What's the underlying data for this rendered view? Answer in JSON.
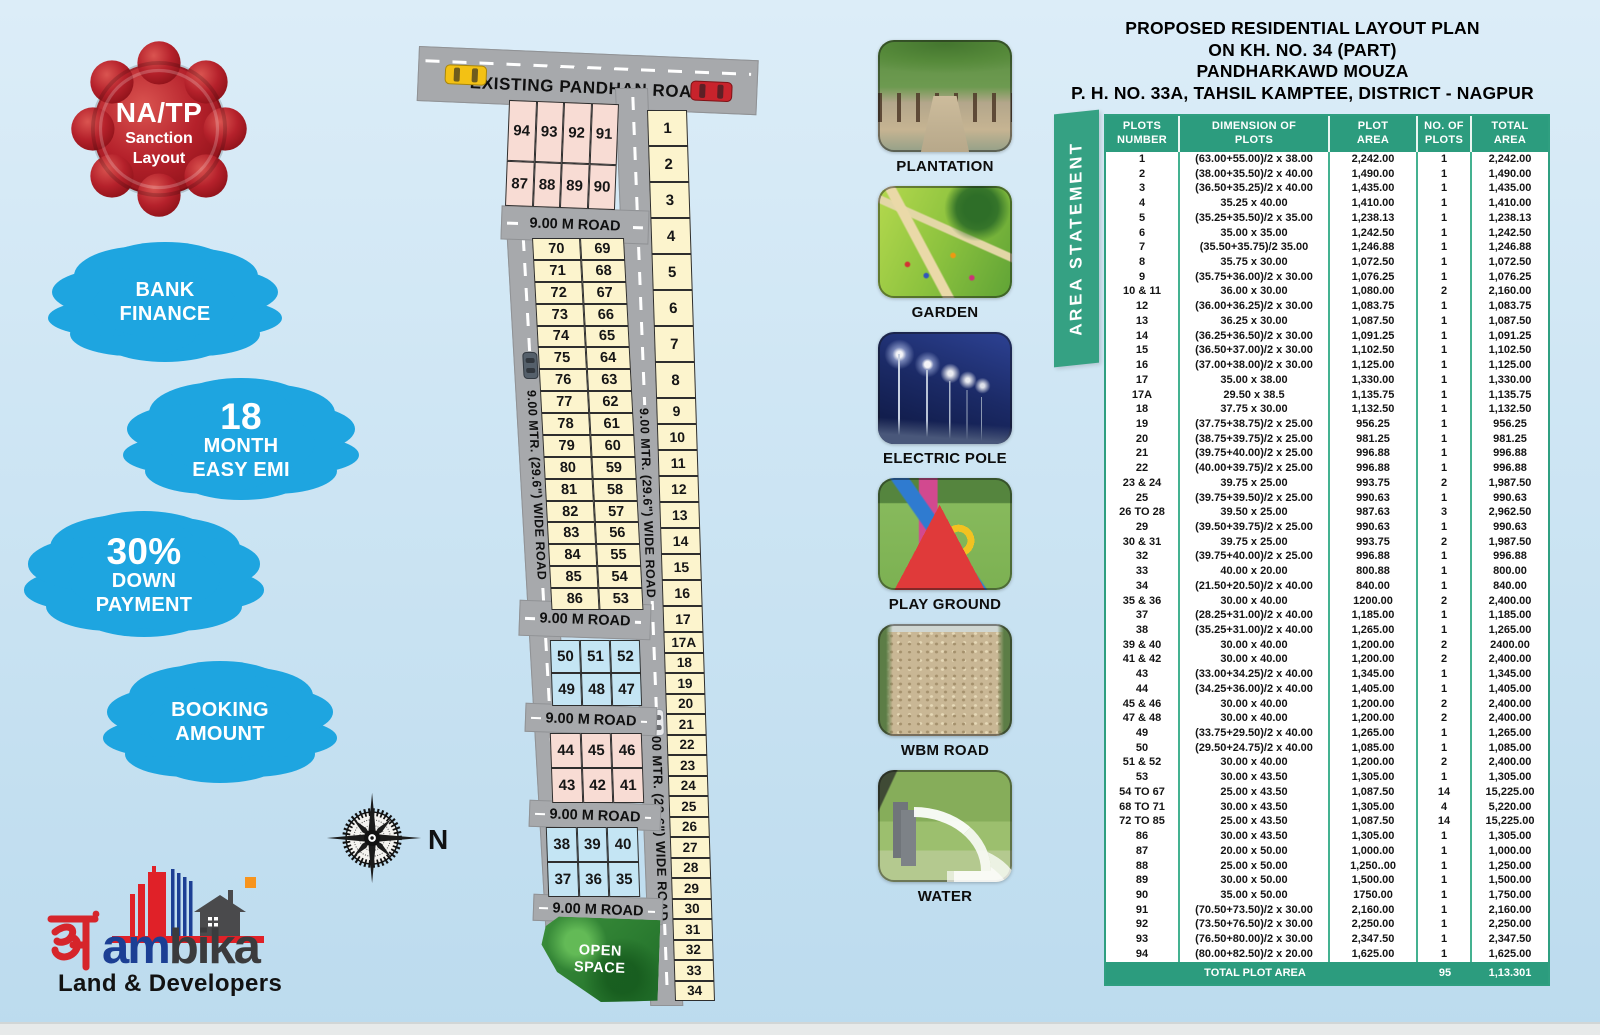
{
  "left_panel": {
    "seal": {
      "l1": "NA/TP",
      "l2": "Sanction",
      "l3": "Layout"
    },
    "cloud_bank": {
      "l1": "BANK",
      "l2": "FINANCE"
    },
    "cloud_emi": {
      "big": "18",
      "l1": "MONTH",
      "l2": "EASY EMI"
    },
    "cloud_down": {
      "big": "30%",
      "l1": "DOWN",
      "l2": "PAYMENT"
    },
    "cloud_booking": {
      "l1": "BOOKING",
      "l2": "AMOUNT"
    },
    "compass_north": "N",
    "logo": {
      "devanagari": "अं",
      "name_blue": "am",
      "name_dark": "bika",
      "tagline": "Land & Developers"
    }
  },
  "map": {
    "top_road": "EXISTING PANDHAN ROAD",
    "road_label": "9.00 M ROAD",
    "wide_road_label": "9.00 MTR. (29.6\") WIDE ROAD",
    "open_space_l1": "OPEN",
    "open_space_l2": "SPACE",
    "pink_top": [
      [
        "94",
        "93",
        "92",
        "91"
      ],
      [
        "87",
        "88",
        "89",
        "90"
      ]
    ],
    "mid_rows": [
      [
        "70",
        "69"
      ],
      [
        "71",
        "68"
      ],
      [
        "72",
        "67"
      ],
      [
        "73",
        "66"
      ],
      [
        "74",
        "65"
      ],
      [
        "75",
        "64"
      ],
      [
        "76",
        "63"
      ],
      [
        "77",
        "62"
      ],
      [
        "78",
        "61"
      ],
      [
        "79",
        "60"
      ],
      [
        "80",
        "59"
      ],
      [
        "81",
        "58"
      ],
      [
        "82",
        "57"
      ],
      [
        "83",
        "56"
      ],
      [
        "84",
        "55"
      ],
      [
        "85",
        "54"
      ],
      [
        "86",
        "53"
      ]
    ],
    "right_col": [
      "1",
      "2",
      "3",
      "4",
      "5",
      "6",
      "7",
      "8",
      "9",
      "10",
      "11",
      "12",
      "13",
      "14",
      "15",
      "16",
      "17",
      "17A",
      "18",
      "19",
      "20",
      "21",
      "22",
      "23",
      "24",
      "25",
      "26",
      "27",
      "28",
      "29",
      "30",
      "31",
      "32",
      "33",
      "34"
    ],
    "blue_block_a": [
      [
        "50",
        "51",
        "52"
      ],
      [
        "49",
        "48",
        "47"
      ]
    ],
    "pink_block_b": [
      [
        "44",
        "45",
        "46"
      ],
      [
        "43",
        "42",
        "41"
      ]
    ],
    "blue_block_c": [
      [
        "38",
        "39",
        "40"
      ],
      [
        "37",
        "36",
        "35"
      ]
    ]
  },
  "gallery": [
    {
      "label": "PLANTATION",
      "art": "plantation"
    },
    {
      "label": "GARDEN",
      "art": "garden"
    },
    {
      "label": "ELECTRIC POLE",
      "art": "electric"
    },
    {
      "label": "PLAY GROUND",
      "art": "playground"
    },
    {
      "label": "WBM ROAD",
      "art": "wbm"
    },
    {
      "label": "WATER",
      "art": "water"
    }
  ],
  "statement": {
    "title_lines": [
      "PROPOSED RESIDENTIAL LAYOUT PLAN",
      "ON KH. NO. 34 (PART)",
      "PANDHARKAWD MOUZA",
      "P. H. NO. 33A, TAHSIL KAMPTEE, DISTRICT - NAGPUR"
    ],
    "banner": "AREA STATEMENT",
    "headers": [
      [
        "PLOTS",
        "NUMBER"
      ],
      [
        "DIMENSION OF",
        "PLOTS"
      ],
      [
        "PLOT",
        "AREA"
      ],
      [
        "NO. OF",
        "PLOTS"
      ],
      [
        "TOTAL",
        "AREA"
      ]
    ],
    "rows": [
      [
        "1",
        "(63.00+55.00)/2 x 38.00",
        "2,242.00",
        "1",
        "2,242.00"
      ],
      [
        "2",
        "(38.00+35.50)/2 x 40.00",
        "1,490.00",
        "1",
        "1,490.00"
      ],
      [
        "3",
        "(36.50+35.25)/2 x 40.00",
        "1,435.00",
        "1",
        "1,435.00"
      ],
      [
        "4",
        "35.25 x 40.00",
        "1,410.00",
        "1",
        "1,410.00"
      ],
      [
        "5",
        "(35.25+35.50)/2 x 35.00",
        "1,238.13",
        "1",
        "1,238.13"
      ],
      [
        "6",
        "35.00 x 35.00",
        "1,242.50",
        "1",
        "1,242.50"
      ],
      [
        "7",
        "(35.50+35.75)/2 35.00",
        "1,246.88",
        "1",
        "1,246.88"
      ],
      [
        "8",
        "35.75 x 30.00",
        "1,072.50",
        "1",
        "1,072.50"
      ],
      [
        "9",
        "(35.75+36.00)/2 x 30.00",
        "1,076.25",
        "1",
        "1,076.25"
      ],
      [
        "10 & 11",
        "36.00 x 30.00",
        "1,080.00",
        "2",
        "2,160.00"
      ],
      [
        "12",
        "(36.00+36.25)/2 x 30.00",
        "1,083.75",
        "1",
        "1,083.75"
      ],
      [
        "13",
        "36.25 x 30.00",
        "1,087.50",
        "1",
        "1,087.50"
      ],
      [
        "14",
        "(36.25+36.50)/2 x 30.00",
        "1,091.25",
        "1",
        "1,091.25"
      ],
      [
        "15",
        "(36.50+37.00)/2 x 30.00",
        "1,102.50",
        "1",
        "1,102.50"
      ],
      [
        "16",
        "(37.00+38.00)/2 x 30.00",
        "1,125.00",
        "1",
        "1,125.00"
      ],
      [
        "17",
        "35.00 x 38.00",
        "1,330.00",
        "1",
        "1,330.00"
      ],
      [
        "17A",
        "29.50 x 38.5",
        "1,135.75",
        "1",
        "1,135.75"
      ],
      [
        "18",
        "37.75 x 30.00",
        "1,132.50",
        "1",
        "1,132.50"
      ],
      [
        "19",
        "(37.75+38.75)/2 x 25.00",
        "956.25",
        "1",
        "956.25"
      ],
      [
        "20",
        "(38.75+39.75)/2 x 25.00",
        "981.25",
        "1",
        "981.25"
      ],
      [
        "21",
        "(39.75+40.00)/2 x 25.00",
        "996.88",
        "1",
        "996.88"
      ],
      [
        "22",
        "(40.00+39.75)/2 x 25.00",
        "996.88",
        "1",
        "996.88"
      ],
      [
        "23 & 24",
        "39.75 x 25.00",
        "993.75",
        "2",
        "1,987.50"
      ],
      [
        "25",
        "(39.75+39.50)/2 x 25.00",
        "990.63",
        "1",
        "990.63"
      ],
      [
        "26 TO 28",
        "39.50 x 25.00",
        "987.63",
        "3",
        "2,962.50"
      ],
      [
        "29",
        "(39.50+39.75)/2 x 25.00",
        "990.63",
        "1",
        "990.63"
      ],
      [
        "30 & 31",
        "39.75 x 25.00",
        "993.75",
        "2",
        "1,987.50"
      ],
      [
        "32",
        "(39.75+40.00)/2 x 25.00",
        "996.88",
        "1",
        "996.88"
      ],
      [
        "33",
        "40.00 x 20.00",
        "800.88",
        "1",
        "800.00"
      ],
      [
        "34",
        "(21.50+20.50)/2 x 40.00",
        "840.00",
        "1",
        "840.00"
      ],
      [
        "35 & 36",
        "30.00 x 40.00",
        "1200.00",
        "2",
        "2,400.00"
      ],
      [
        "37",
        "(28.25+31.00)/2 x 40.00",
        "1,185.00",
        "1",
        "1,185.00"
      ],
      [
        "38",
        "(35.25+31.00)/2 x 40.00",
        "1,265.00",
        "1",
        "1,265.00"
      ],
      [
        "39 & 40",
        "30.00 x 40.00",
        "1,200.00",
        "2",
        "2400.00"
      ],
      [
        "41 & 42",
        "30.00 x 40.00",
        "1,200.00",
        "2",
        "2,400.00"
      ],
      [
        "43",
        "(33.00+34.25)/2 x 40.00",
        "1,345.00",
        "1",
        "1,345.00"
      ],
      [
        "44",
        "(34.25+36.00)/2 x 40.00",
        "1,405.00",
        "1",
        "1,405.00"
      ],
      [
        "45 & 46",
        "30.00 x 40.00",
        "1,200.00",
        "2",
        "2,400.00"
      ],
      [
        "47 & 48",
        "30.00 x 40.00",
        "1,200.00",
        "2",
        "2,400.00"
      ],
      [
        "49",
        "(33.75+29.50)/2 x 40.00",
        "1,265.00",
        "1",
        "1,265.00"
      ],
      [
        "50",
        "(29.50+24.75)/2 x 40.00",
        "1,085.00",
        "1",
        "1,085.00"
      ],
      [
        "51 & 52",
        "30.00 x 40.00",
        "1,200.00",
        "2",
        "2,400.00"
      ],
      [
        "53",
        "30.00 x 43.50",
        "1,305.00",
        "1",
        "1,305.00"
      ],
      [
        "54 TO 67",
        "25.00 x 43.50",
        "1,087.50",
        "14",
        "15,225.00"
      ],
      [
        "68 TO 71",
        "30.00 x 43.50",
        "1,305.00",
        "4",
        "5,220.00"
      ],
      [
        "72 TO 85",
        "25.00 x 43.50",
        "1,087.50",
        "14",
        "15,225.00"
      ],
      [
        "86",
        "30.00 x 43.50",
        "1,305.00",
        "1",
        "1,305.00"
      ],
      [
        "87",
        "20.00 x 50.00",
        "1,000.00",
        "1",
        "1,000.00"
      ],
      [
        "88",
        "25.00 x 50.00",
        "1,250..00",
        "1",
        "1,250.00"
      ],
      [
        "89",
        "30.00 x 50.00",
        "1,500.00",
        "1",
        "1,500.00"
      ],
      [
        "90",
        "35.00 x 50.00",
        "1750.00",
        "1",
        "1,750.00"
      ],
      [
        "91",
        "(70.50+73.50)/2 x 30.00",
        "2,160.00",
        "1",
        "2,160.00"
      ],
      [
        "92",
        "(73.50+76.50)/2 x 30.00",
        "2,250.00",
        "1",
        "2,250.00"
      ],
      [
        "93",
        "(76.50+80.00)/2 x 30.00",
        "2,347.50",
        "1",
        "2,347.50"
      ],
      [
        "94",
        "(80.00+82.50)/2 x 20.00",
        "1,625.00",
        "1",
        "1,625.00"
      ]
    ],
    "total": {
      "label": "TOTAL PLOT AREA",
      "plots": "95",
      "area": "1,13.301"
    }
  },
  "colors": {
    "cloud_blue": "#1ea5e0",
    "seal_red": "#b5212b",
    "table_green": "#2c9c7e",
    "banner_green": "#35a183",
    "road_gray": "#a7a9ac",
    "plot_cream": "#fcf4cd",
    "plot_pink": "#f8dcd4",
    "plot_blue": "#c4e5f4"
  }
}
